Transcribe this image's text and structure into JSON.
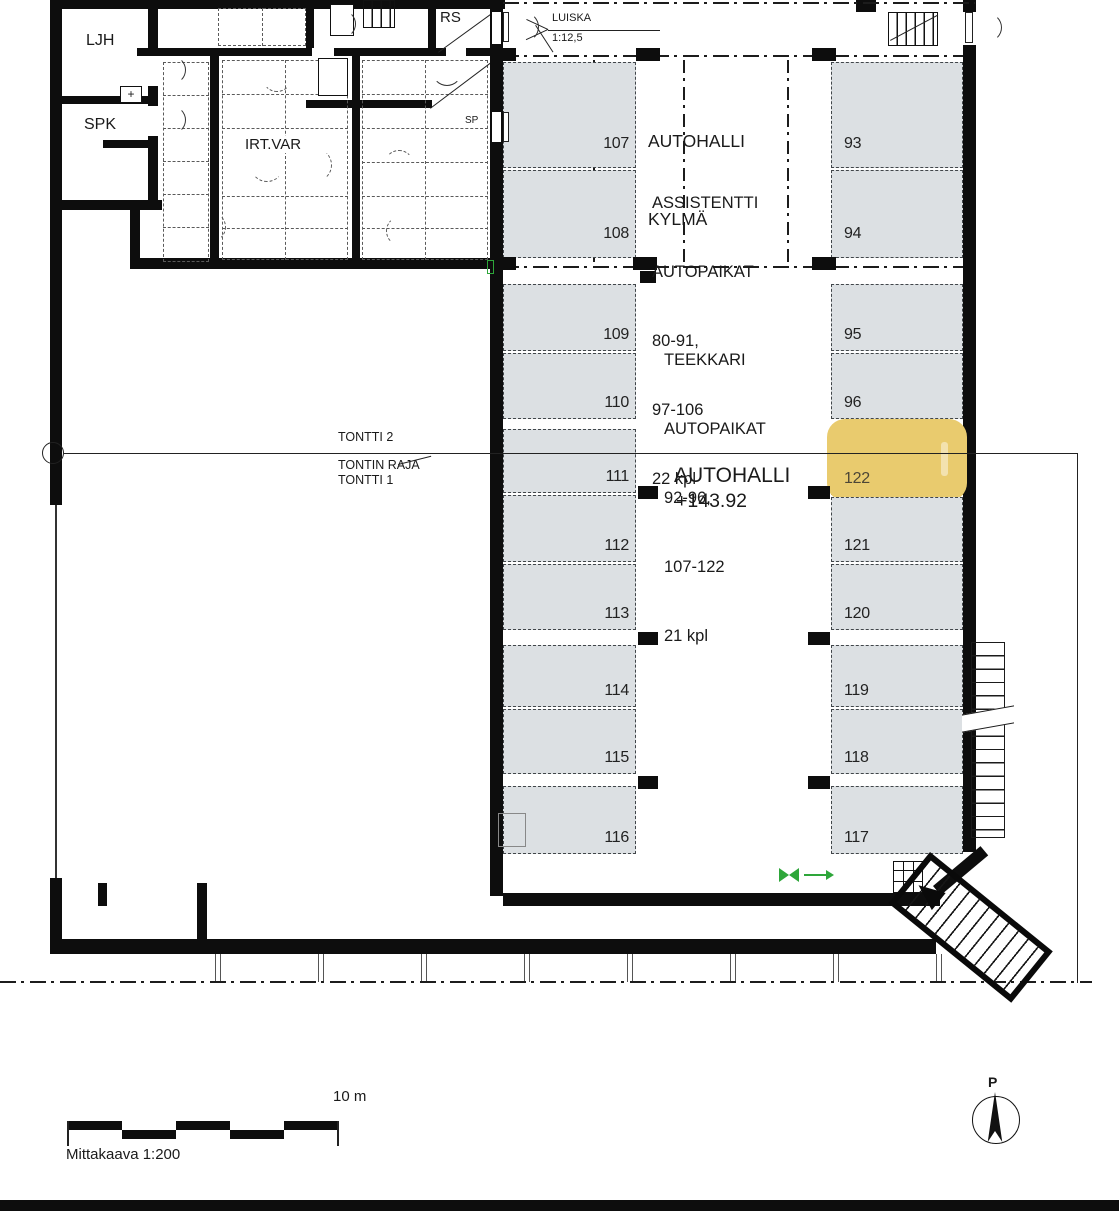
{
  "plan": {
    "rooms": {
      "ljh": "LJH",
      "spk": "SPK",
      "irtvar": "IRT.VAR",
      "rs": "RS",
      "sp": "SP",
      "plus": "+"
    },
    "ramp": {
      "label": "LUISKA",
      "slope": "1:12,5"
    },
    "zones": {
      "hall_cold": [
        "AUTOHALLI",
        "KYLMÄ"
      ],
      "assistentti": [
        "ASSISTENTTI",
        "AUTOPAIKAT",
        "80-91,",
        "97-106",
        "22 kpl"
      ],
      "teekkari": [
        "TEEKKARI",
        "AUTOPAIKAT",
        "92-96,",
        "107-122",
        "21 kpl"
      ],
      "hall": {
        "name": "AUTOHALLI",
        "level": "+143.92"
      }
    },
    "boundary": {
      "tontti2": "TONTTI 2",
      "raja": "TONTIN RAJA",
      "tontti1": "TONTTI 1"
    },
    "stalls": {
      "left": [
        "107",
        "108",
        "109",
        "110",
        "111",
        "112",
        "113",
        "114",
        "115",
        "116"
      ],
      "right": [
        "93",
        "94",
        "95",
        "96",
        "122",
        "121",
        "120",
        "119",
        "118",
        "117"
      ],
      "highlighted": "122"
    },
    "scalebar": {
      "label": "Mittakaava 1:200",
      "distance": "10 m"
    },
    "north": {
      "label": "P"
    },
    "colors": {
      "stall_fill": "#dce0e3",
      "highlight": "#e9cb6e",
      "green": "#2ea63a",
      "wall": "#0d0d0d"
    }
  }
}
